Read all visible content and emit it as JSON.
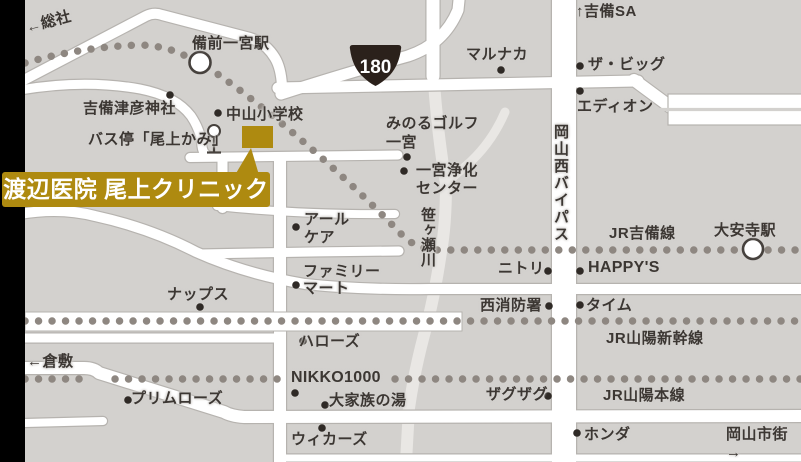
{
  "map": {
    "colors": {
      "background": "#d3d1ce",
      "road": "#ffffff",
      "road_casing": "#b6b3af",
      "railway_dot": "#8e8781",
      "text": "#3c3733",
      "accent_gold": "#ae8a10",
      "route_shield": "#2b211b",
      "river": "#e9e7e4"
    },
    "route_shield_number": "180",
    "labels": {
      "sosha": "←総社",
      "bizen_ichinomiya_sta": "備前一宮駅",
      "kibi_sa": "↑吉備SA",
      "marunaka": "マルナカ",
      "the_big": "ザ・ビッグ",
      "edion": "エディオン",
      "kibitsuhiko_shrine": "吉備津彦神社",
      "nakayama_school": "中山小学校",
      "bus_stop": "バス停「尾上かみ」",
      "clinic": "渡辺医院 尾上クリニック",
      "minoru_golf": "みのるゴルフ\n一宮",
      "jokacenter": "一宮浄化\nセンター",
      "okayama_nishi_bypass": "岡山西バイパス",
      "sasagase_river": "笹ヶ瀬川",
      "r_care": "アール\nケア",
      "jr_kibi_line": "JR吉備線",
      "daianji_sta": "大安寺駅",
      "family_mart": "ファミリー\nマート",
      "nitori": "ニトリ",
      "happys": "HAPPY'S",
      "naps": "ナップス",
      "nishi_fire_station": "西消防署",
      "time": "タイム",
      "jr_sanyo_shinkansen": "JR山陽新幹線",
      "kurashiki": "←倉敷",
      "halows": "ハローズ",
      "nikko1000": "NIKKO1000",
      "primrose": "プリムローズ",
      "daikazoku_no_yu": "大家族の湯",
      "jr_sanyo_honsen": "JR山陽本線",
      "zagzag": "ザグザグ",
      "wickers": "ウィカーズ",
      "honda": "ホンダ",
      "okayama_shigai": "岡山市街→"
    }
  }
}
